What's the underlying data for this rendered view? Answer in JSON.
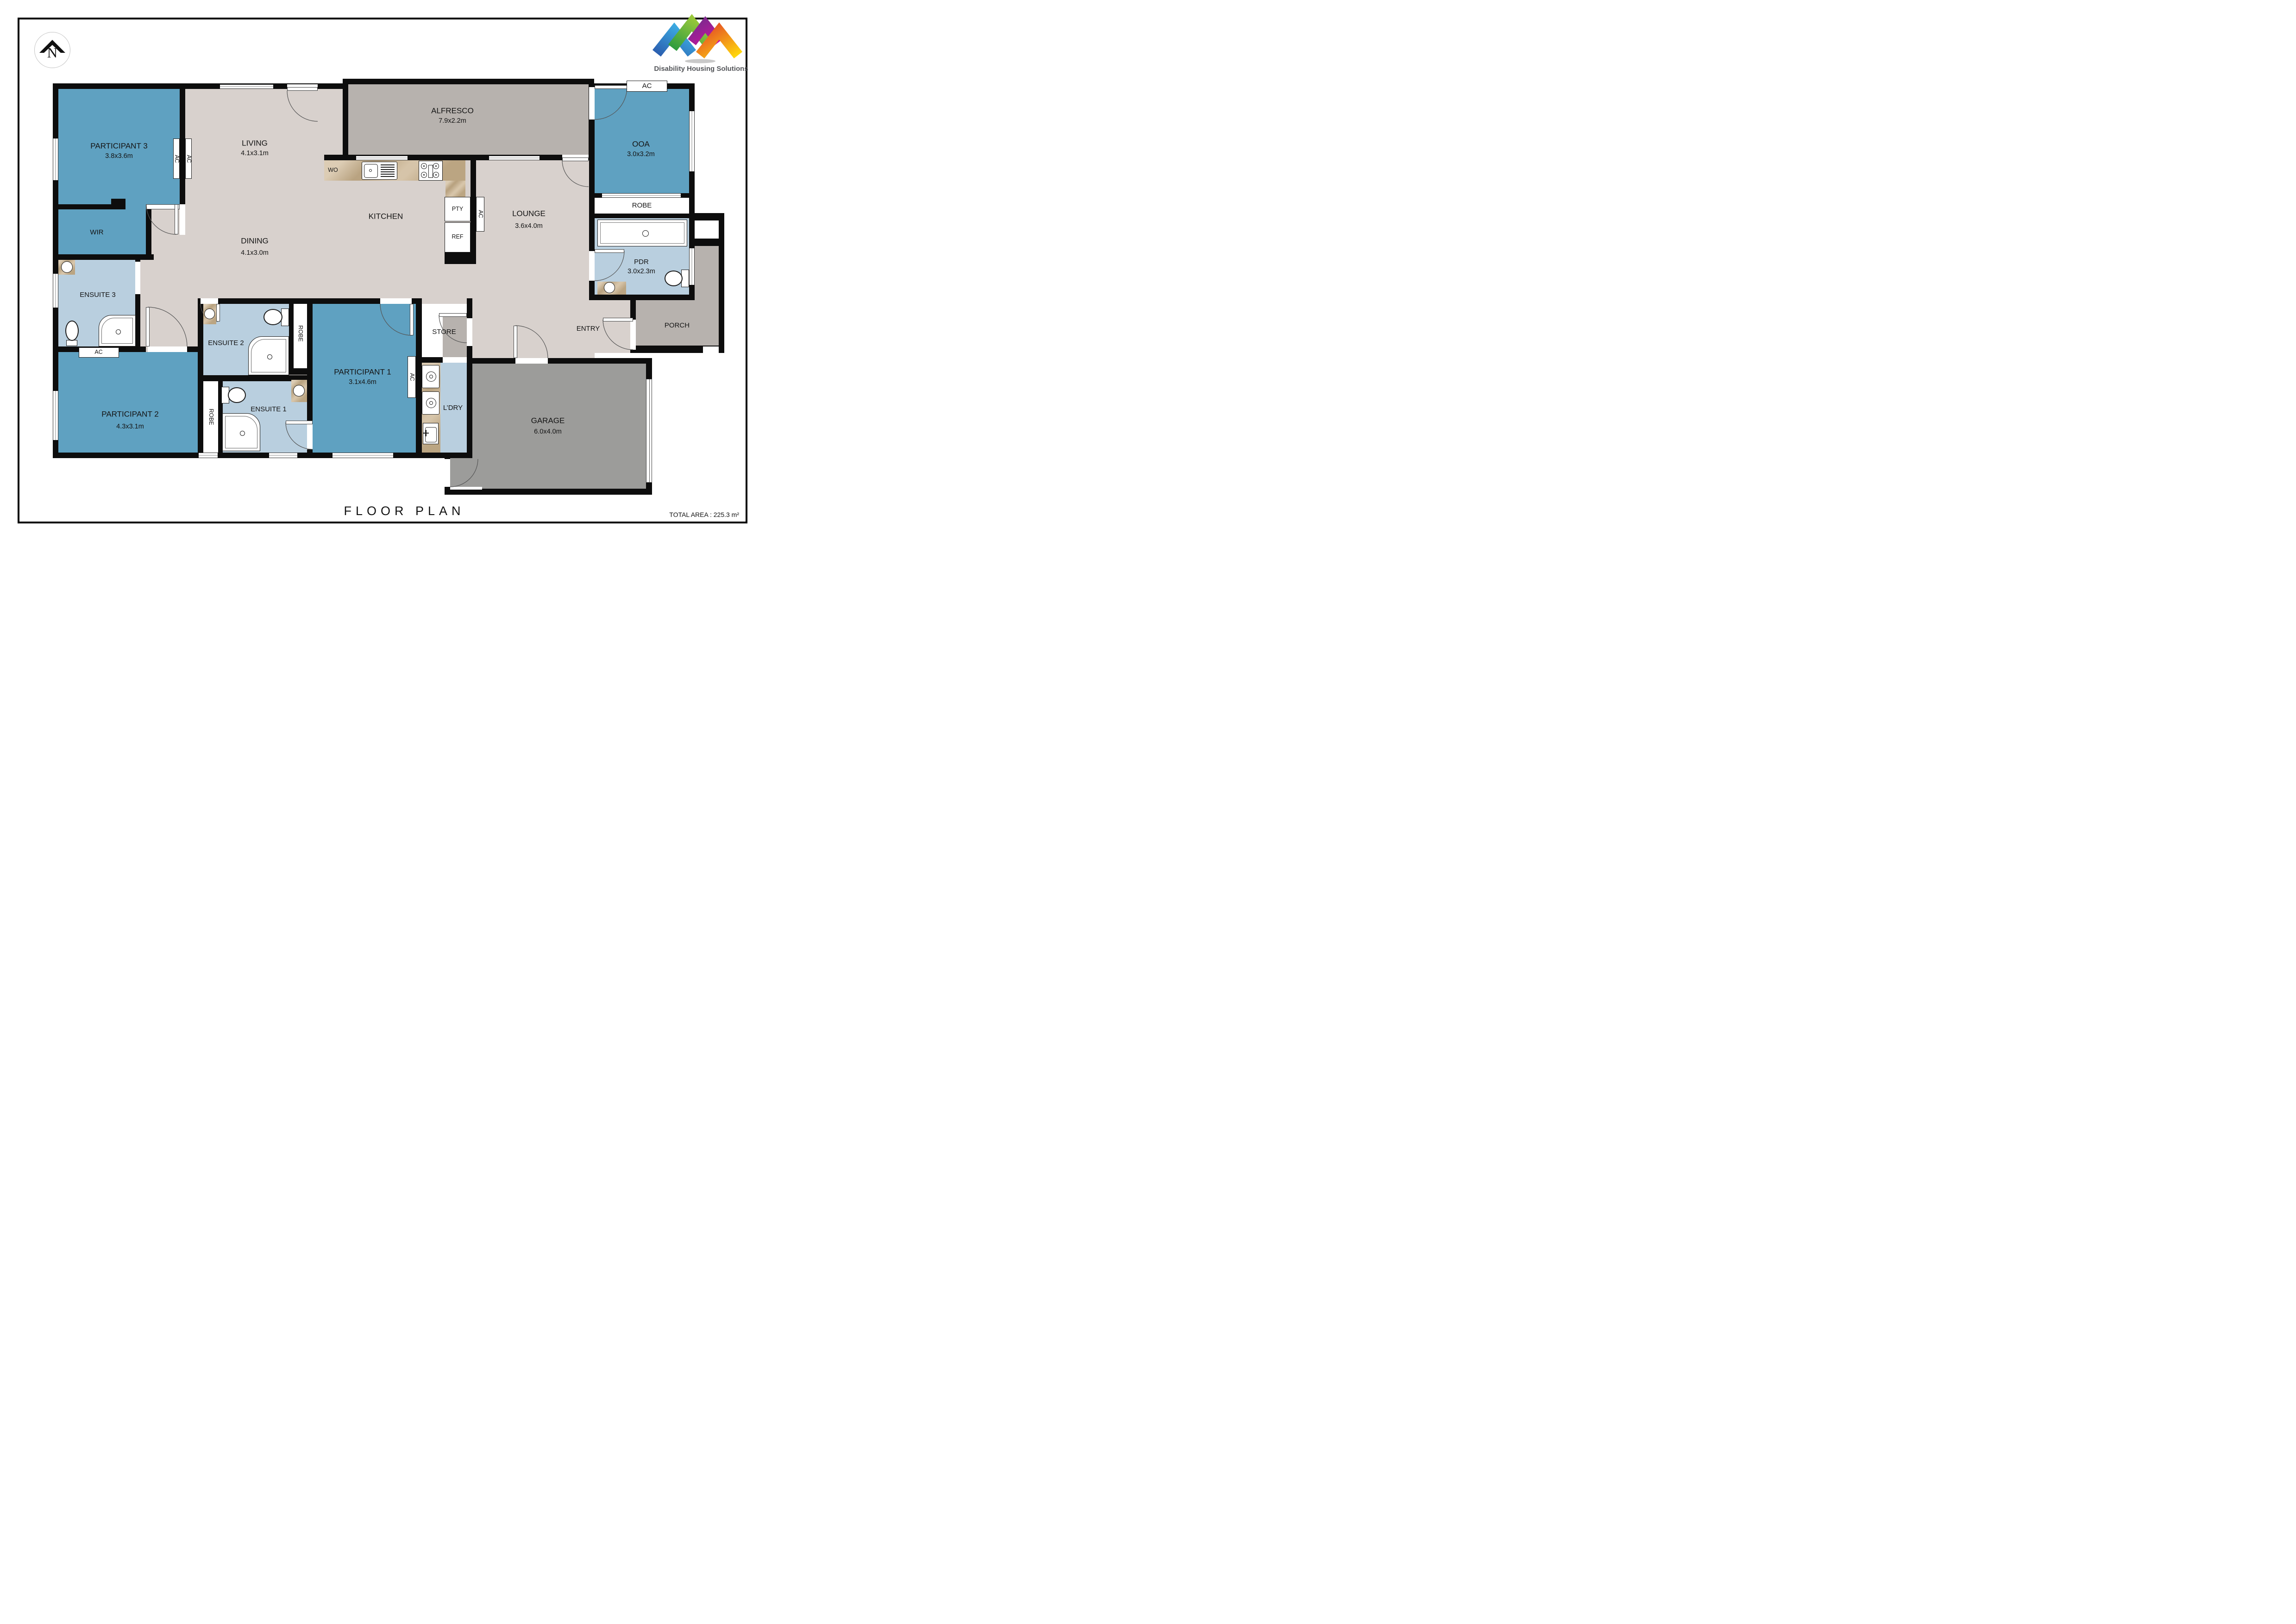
{
  "colors": {
    "floor": "#d8d1cd",
    "bedroom": "#5fa1c1",
    "bathroom": "#b9cfdf",
    "outdoor": "#b7b2ae",
    "garage": "#9c9c9a",
    "bench": "#c9b18c"
  },
  "branding": {
    "company": "Disability Housing Solutions"
  },
  "compass": {
    "north_label": "N"
  },
  "title_block": {
    "title": "FLOOR PLAN",
    "total_area": "TOTAL AREA : 225.3 m²"
  },
  "rooms": {
    "participant3": {
      "name": "PARTICIPANT 3",
      "dims": "3.8x3.6m"
    },
    "wir": {
      "name": "WIR"
    },
    "living": {
      "name": "LIVING",
      "dims": "4.1x3.1m"
    },
    "alfresco": {
      "name": "ALFRESCO",
      "dims": "7.9x2.2m"
    },
    "ooa": {
      "name": "OOA",
      "dims": "3.0x3.2m"
    },
    "kitchen": {
      "name": "KITCHEN"
    },
    "dining": {
      "name": "DINING",
      "dims": "4.1x3.0m"
    },
    "lounge": {
      "name": "LOUNGE",
      "dims": "3.6x4.0m"
    },
    "ensuite3": {
      "name": "ENSUITE 3"
    },
    "ensuite2": {
      "name": "ENSUITE 2"
    },
    "ensuite1": {
      "name": "ENSUITE 1"
    },
    "participant2": {
      "name": "PARTICIPANT 2",
      "dims": "4.3x3.1m"
    },
    "participant1": {
      "name": "PARTICIPANT 1",
      "dims": "3.1x4.6m"
    },
    "pdr": {
      "name": "PDR",
      "dims": "3.0x2.3m"
    },
    "robe": {
      "name": "ROBE"
    },
    "store": {
      "name": "STORE"
    },
    "ldry": {
      "name": "L’DRY"
    },
    "entry": {
      "name": "ENTRY"
    },
    "porch": {
      "name": "PORCH"
    },
    "garage": {
      "name": "GARAGE",
      "dims": "6.0x4.0m"
    }
  },
  "markers": {
    "ac": "AC",
    "wo": "WO",
    "pty": "PTY",
    "ref": "REF"
  }
}
